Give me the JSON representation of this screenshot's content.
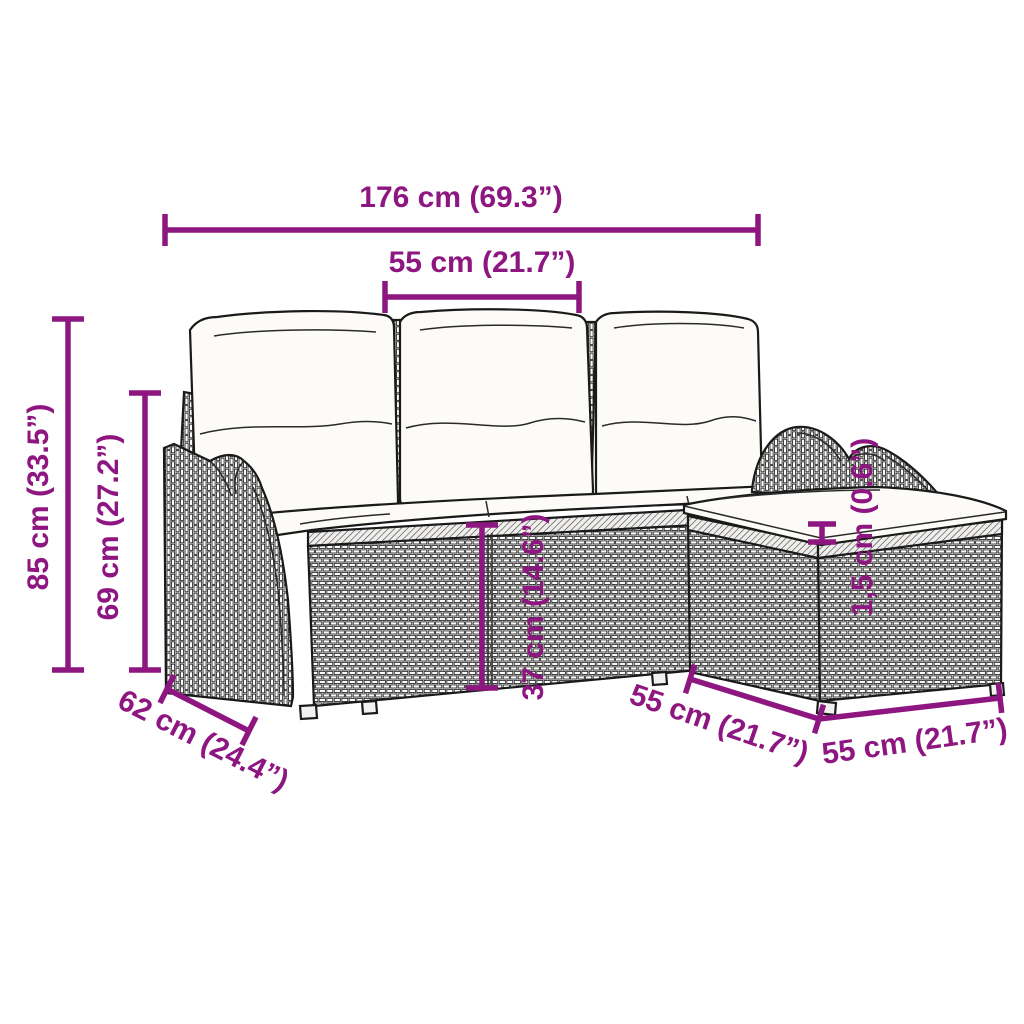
{
  "product": {
    "description": "rattan garden sofa set with cushions and ottoman, line-art dimension diagram"
  },
  "colors": {
    "dimension_accent": "#8E1680",
    "line_art": "#1A1A1A",
    "cushion_fill": "#FCFBF7",
    "background": "#FFFFFF"
  },
  "dimensions": {
    "overall_width": "176 cm (69.3”)",
    "section_width": "55 cm (21.7”)",
    "overall_height": "85 cm (33.5”)",
    "backrest_height": "69 cm (27.2”)",
    "seat_height": "37 cm (14.6”)",
    "cushion_thickness": "1,5 cm (0.6”)",
    "seat_depth": "62 cm (24.4”)",
    "ottoman_depth": "55 cm (21.7”)",
    "ottoman_width": "55 cm (21.7”)"
  }
}
